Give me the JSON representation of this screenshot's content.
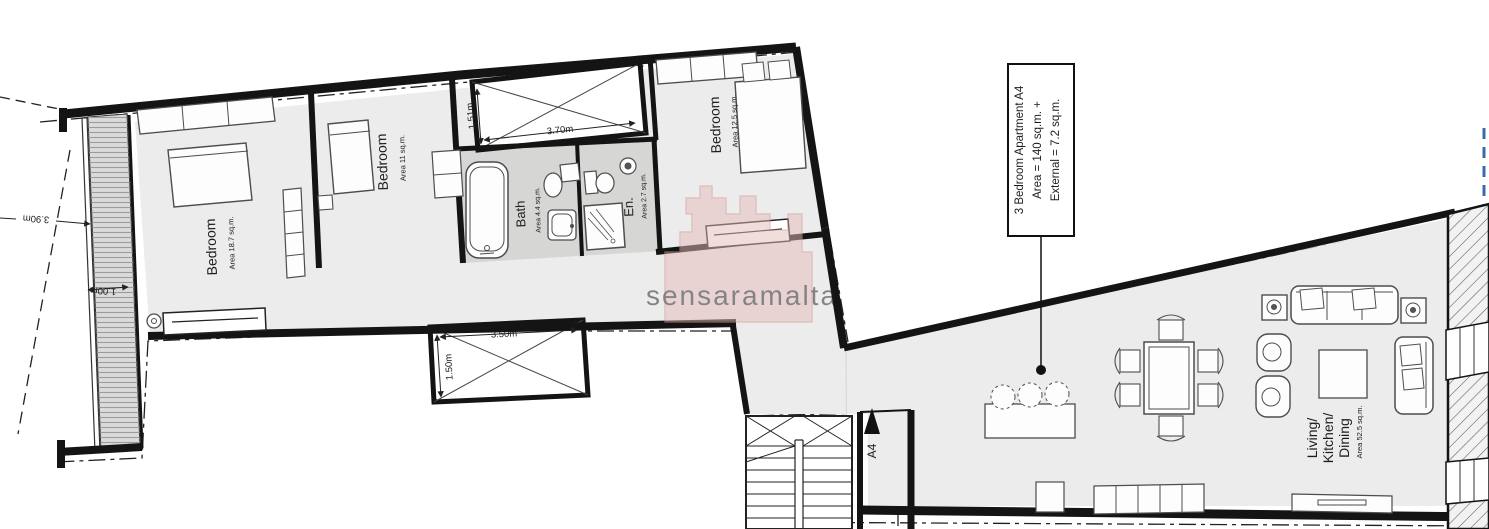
{
  "title_box": {
    "line1": "3 Bedroom Apartment  A4",
    "line2": "Area = 140 sq.m. +",
    "line3": "External = 7.2 sq.m."
  },
  "rooms": {
    "bedroom1": {
      "name": "Bedroom",
      "area": "Area 18.7 sq.m."
    },
    "bedroom2": {
      "name": "Bedroom",
      "area": "Area 11 sq.m."
    },
    "bedroom3": {
      "name": "Bedroom",
      "area": "Area 12.5 sq.m."
    },
    "bath": {
      "name": "Bath",
      "area": "Area 4.4 sq.m."
    },
    "ensuite": {
      "name": "En.",
      "area": "Area 2.7 sq.m."
    },
    "living": {
      "line1": "Living/",
      "line2": "Kitchen/",
      "line3": "Dining",
      "area": "Area 52.5 sq.m."
    }
  },
  "dimensions": {
    "lightwell_width": "3.70m",
    "lightwell_depth": "1.51m",
    "courtyard_width": "3.50m",
    "courtyard_depth": "1.50m",
    "terrace_length": "3.90m",
    "terrace_width": "1.00m"
  },
  "entrance_label": "A4",
  "watermark": "sensaramalta",
  "colors": {
    "wall": "#141414",
    "floor": "#ececec",
    "wet_room_floor": "#d6d6d4",
    "watermark_pink": "#cf9a97",
    "boundary_blue": "#3c6ab0"
  }
}
